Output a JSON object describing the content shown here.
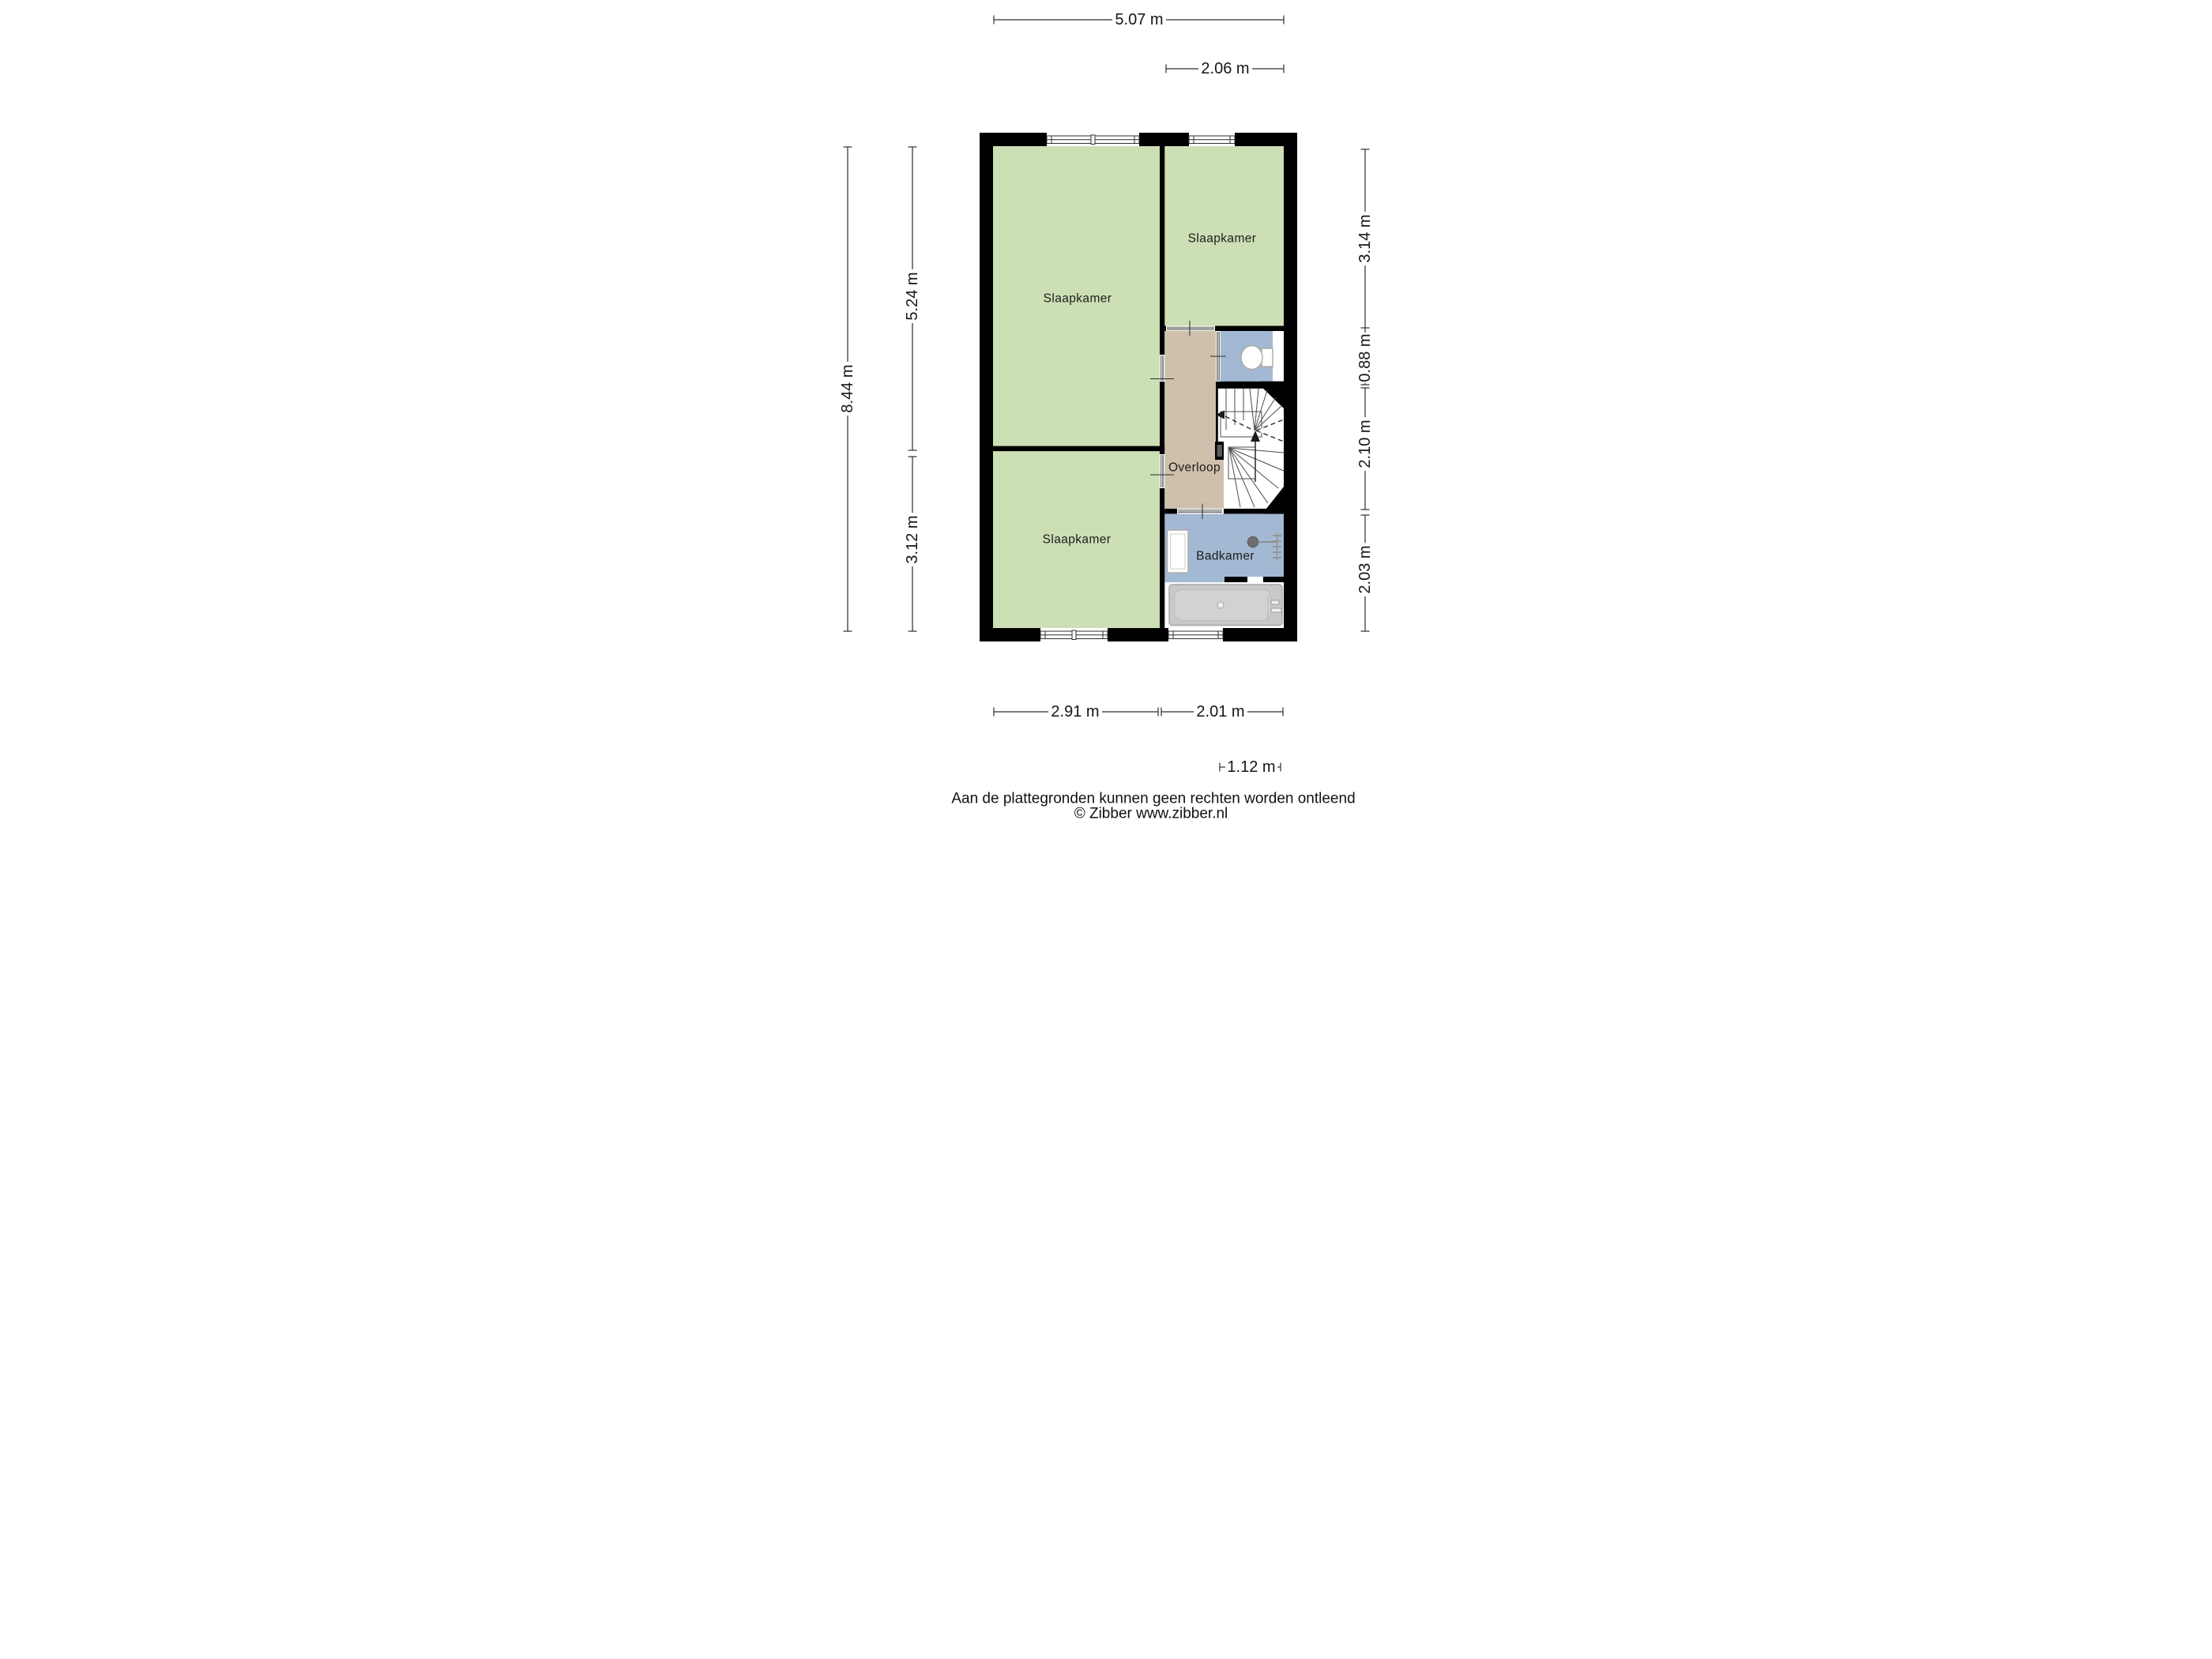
{
  "floorplan": {
    "rooms": [
      {
        "id": "slaapkamer-groot",
        "label": "Slaapkamer"
      },
      {
        "id": "slaapkamer-rechtsboven",
        "label": "Slaapkamer"
      },
      {
        "id": "slaapkamer-linksonder",
        "label": "Slaapkamer"
      },
      {
        "id": "overloop",
        "label": "Overloop"
      },
      {
        "id": "badkamer",
        "label": "Badkamer"
      }
    ],
    "dimensions": {
      "top_total": "5.07 m",
      "top_right": "2.06 m",
      "left_total": "8.44 m",
      "left_upper": "5.24 m",
      "left_lower": "3.12 m",
      "right_upper": "3.14 m",
      "right_toilet": "0.88 m",
      "right_stairs": "2.10 m",
      "right_bath": "2.03 m",
      "bottom_left": "2.91 m",
      "bottom_right": "2.01 m",
      "bottom_inset": "1.12 m"
    },
    "footer": {
      "disclaimer": "Aan de plattegronden kunnen geen rechten worden ontleend",
      "credit": "© Zibber www.zibber.nl"
    },
    "icons": [
      "toilet-icon",
      "bathtub-icon",
      "washbasin-icon",
      "shower-icon",
      "towel-rail-icon",
      "stairs-icon"
    ],
    "colors": {
      "room_green": "#cddfb4",
      "hall_tan": "#cec0ab",
      "bath_blue": "#a3b9d3",
      "wall": "#000000",
      "duct_gray": "#5a5a5a",
      "tub_gray": "#c9c9c9"
    }
  }
}
